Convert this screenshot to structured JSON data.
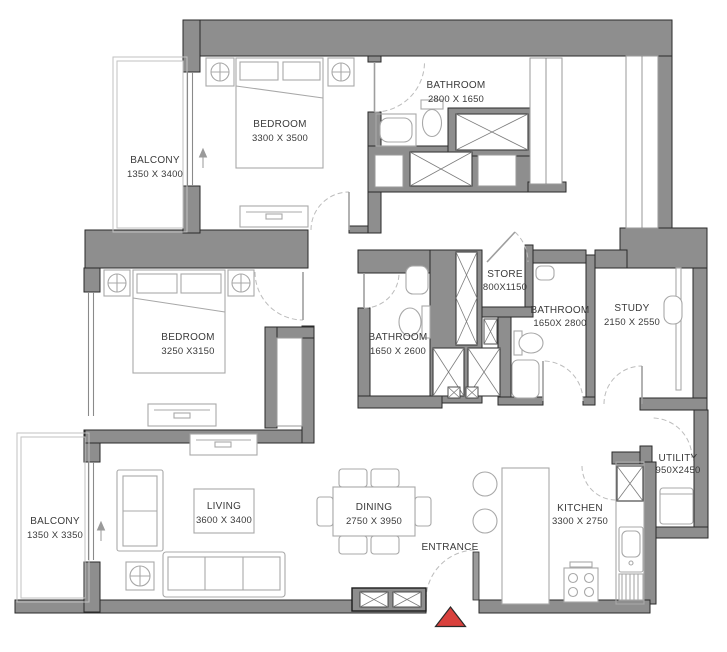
{
  "rooms": [
    {
      "name": "BEDROOM",
      "dims": "3300 X 3500"
    },
    {
      "name": "BATHROOM",
      "dims": "2800 X 1650"
    },
    {
      "name": "BALCONY",
      "dims": "1350 X 3400"
    },
    {
      "name": "BEDROOM",
      "dims": "3250 X3150"
    },
    {
      "name": "BATHROOM",
      "dims": "1650 X 2600"
    },
    {
      "name": "STORE",
      "dims": "800X1150"
    },
    {
      "name": "BATHROOM",
      "dims": "1650X 2800"
    },
    {
      "name": "STUDY",
      "dims": "2150 X 2550"
    },
    {
      "name": "UTILITY",
      "dims": "950X2450"
    },
    {
      "name": "KITCHEN",
      "dims": "3300 X 2750"
    },
    {
      "name": "DINING",
      "dims": "2750 X 3950"
    },
    {
      "name": "LIVING",
      "dims": "3600 X 3400"
    },
    {
      "name": "BALCONY",
      "dims": "1350 X 3350"
    }
  ],
  "entrance": {
    "label": "ENTRANCE"
  },
  "colors": {
    "wall": "#8e8e8e",
    "wall_outline": "#2a2a2a",
    "furniture_line": "#a8a8a8",
    "text": "#3a3a3a",
    "entrance_marker": "#d9413d",
    "background": "#ffffff"
  }
}
